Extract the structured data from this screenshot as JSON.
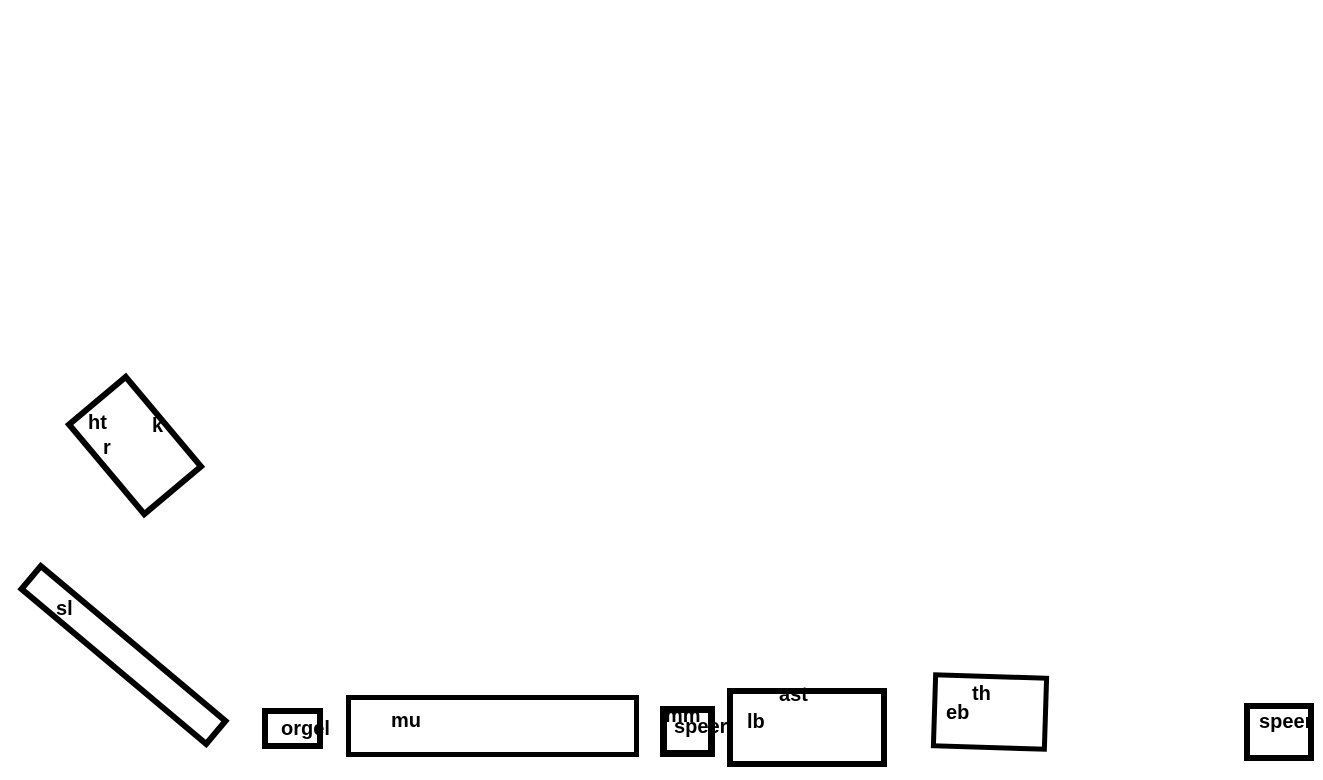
{
  "canvas": {
    "background": "#ffffff",
    "stroke_color": "#000000",
    "text_color": "#000000"
  },
  "boxes": [
    {
      "name": "rotated-box-top-left",
      "labels": [
        "ht",
        "k",
        "r"
      ]
    },
    {
      "name": "slanted-bar",
      "labels": [
        "sl"
      ]
    },
    {
      "name": "orgel-box",
      "labels": [
        "orgel"
      ]
    },
    {
      "name": "mu-box",
      "labels": [
        "mu"
      ]
    },
    {
      "name": "mm-box",
      "labels": [
        "mm",
        "speer"
      ]
    },
    {
      "name": "lb-box",
      "labels": [
        "ast",
        "lb"
      ]
    },
    {
      "name": "th-eb-box",
      "labels": [
        "th",
        "eb"
      ]
    },
    {
      "name": "speer-box",
      "labels": [
        "speer"
      ]
    }
  ]
}
